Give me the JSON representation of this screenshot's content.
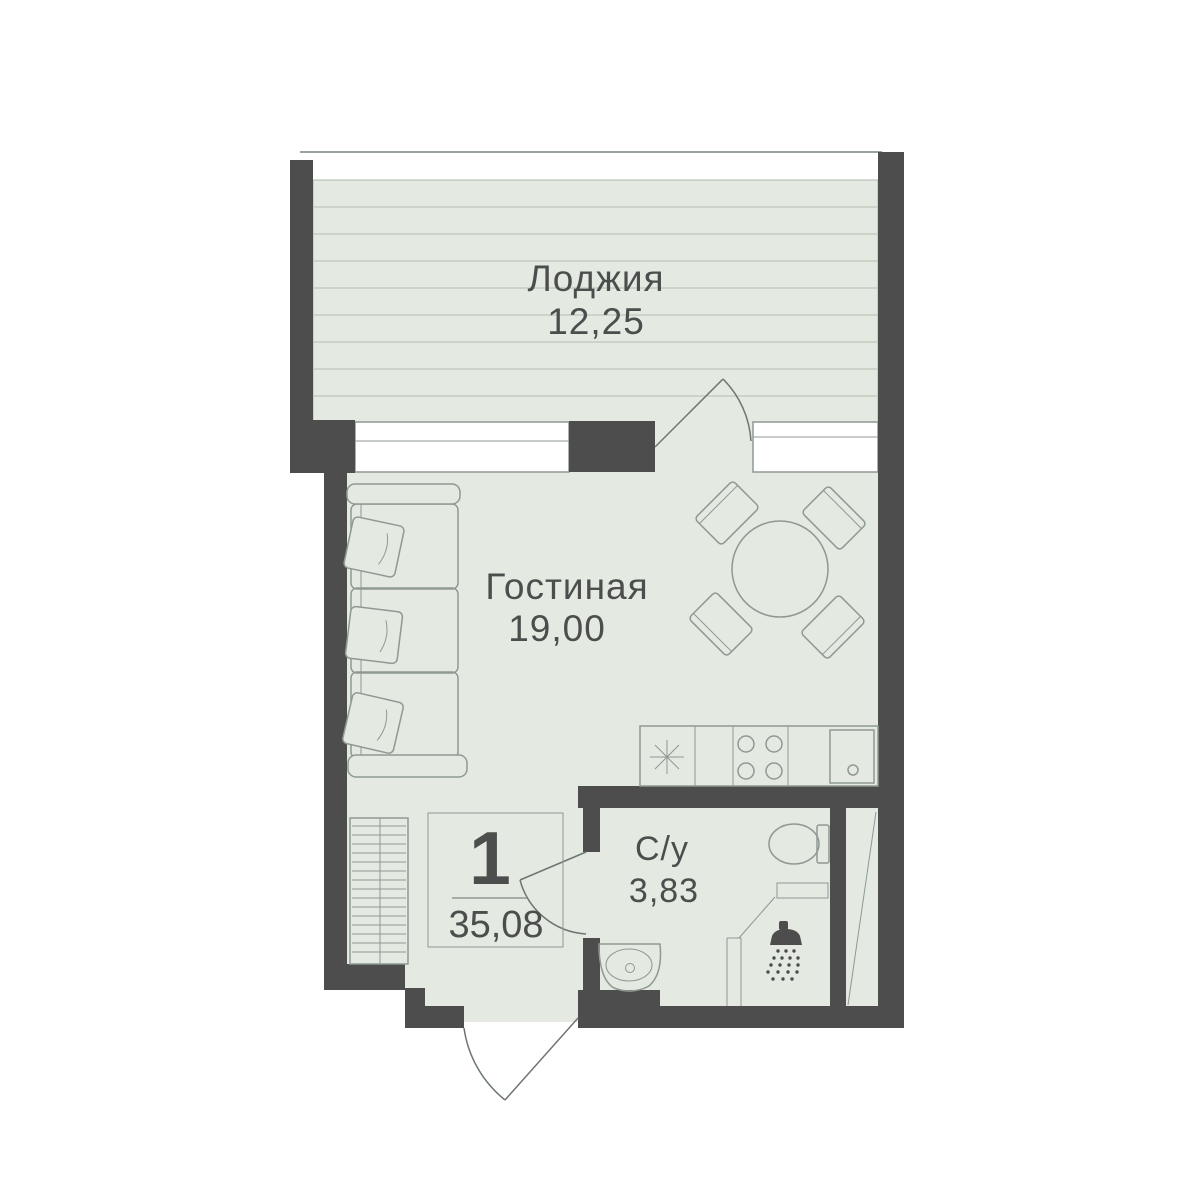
{
  "plan": {
    "rooms": [
      {
        "id": "loggia",
        "label": "Лоджия",
        "area": "12,25"
      },
      {
        "id": "living",
        "label": "Гостиная",
        "area": "19,00"
      },
      {
        "id": "bathroom",
        "label": "С/у",
        "area": "3,83"
      }
    ],
    "stamp": {
      "rooms_count": "1",
      "total_area": "35,08"
    },
    "colors": {
      "wall": "#4d4d4d",
      "floor": "#e4e9e2",
      "loggia_stripes": "#c3cec2",
      "furniture_line": "#8f9991",
      "door_line": "#6d7770",
      "window_fill": "#ffffff",
      "label_text": "#4b4e4c"
    },
    "symbols": [
      "sofa",
      "pillow",
      "round-dining-table",
      "chair",
      "wardrobe",
      "fridge-asterisk",
      "stove-4-burners",
      "kitchen-sink",
      "toilet",
      "shower-head",
      "bathroom-sink",
      "door-swing",
      "window",
      "ventilation-shaft"
    ]
  }
}
